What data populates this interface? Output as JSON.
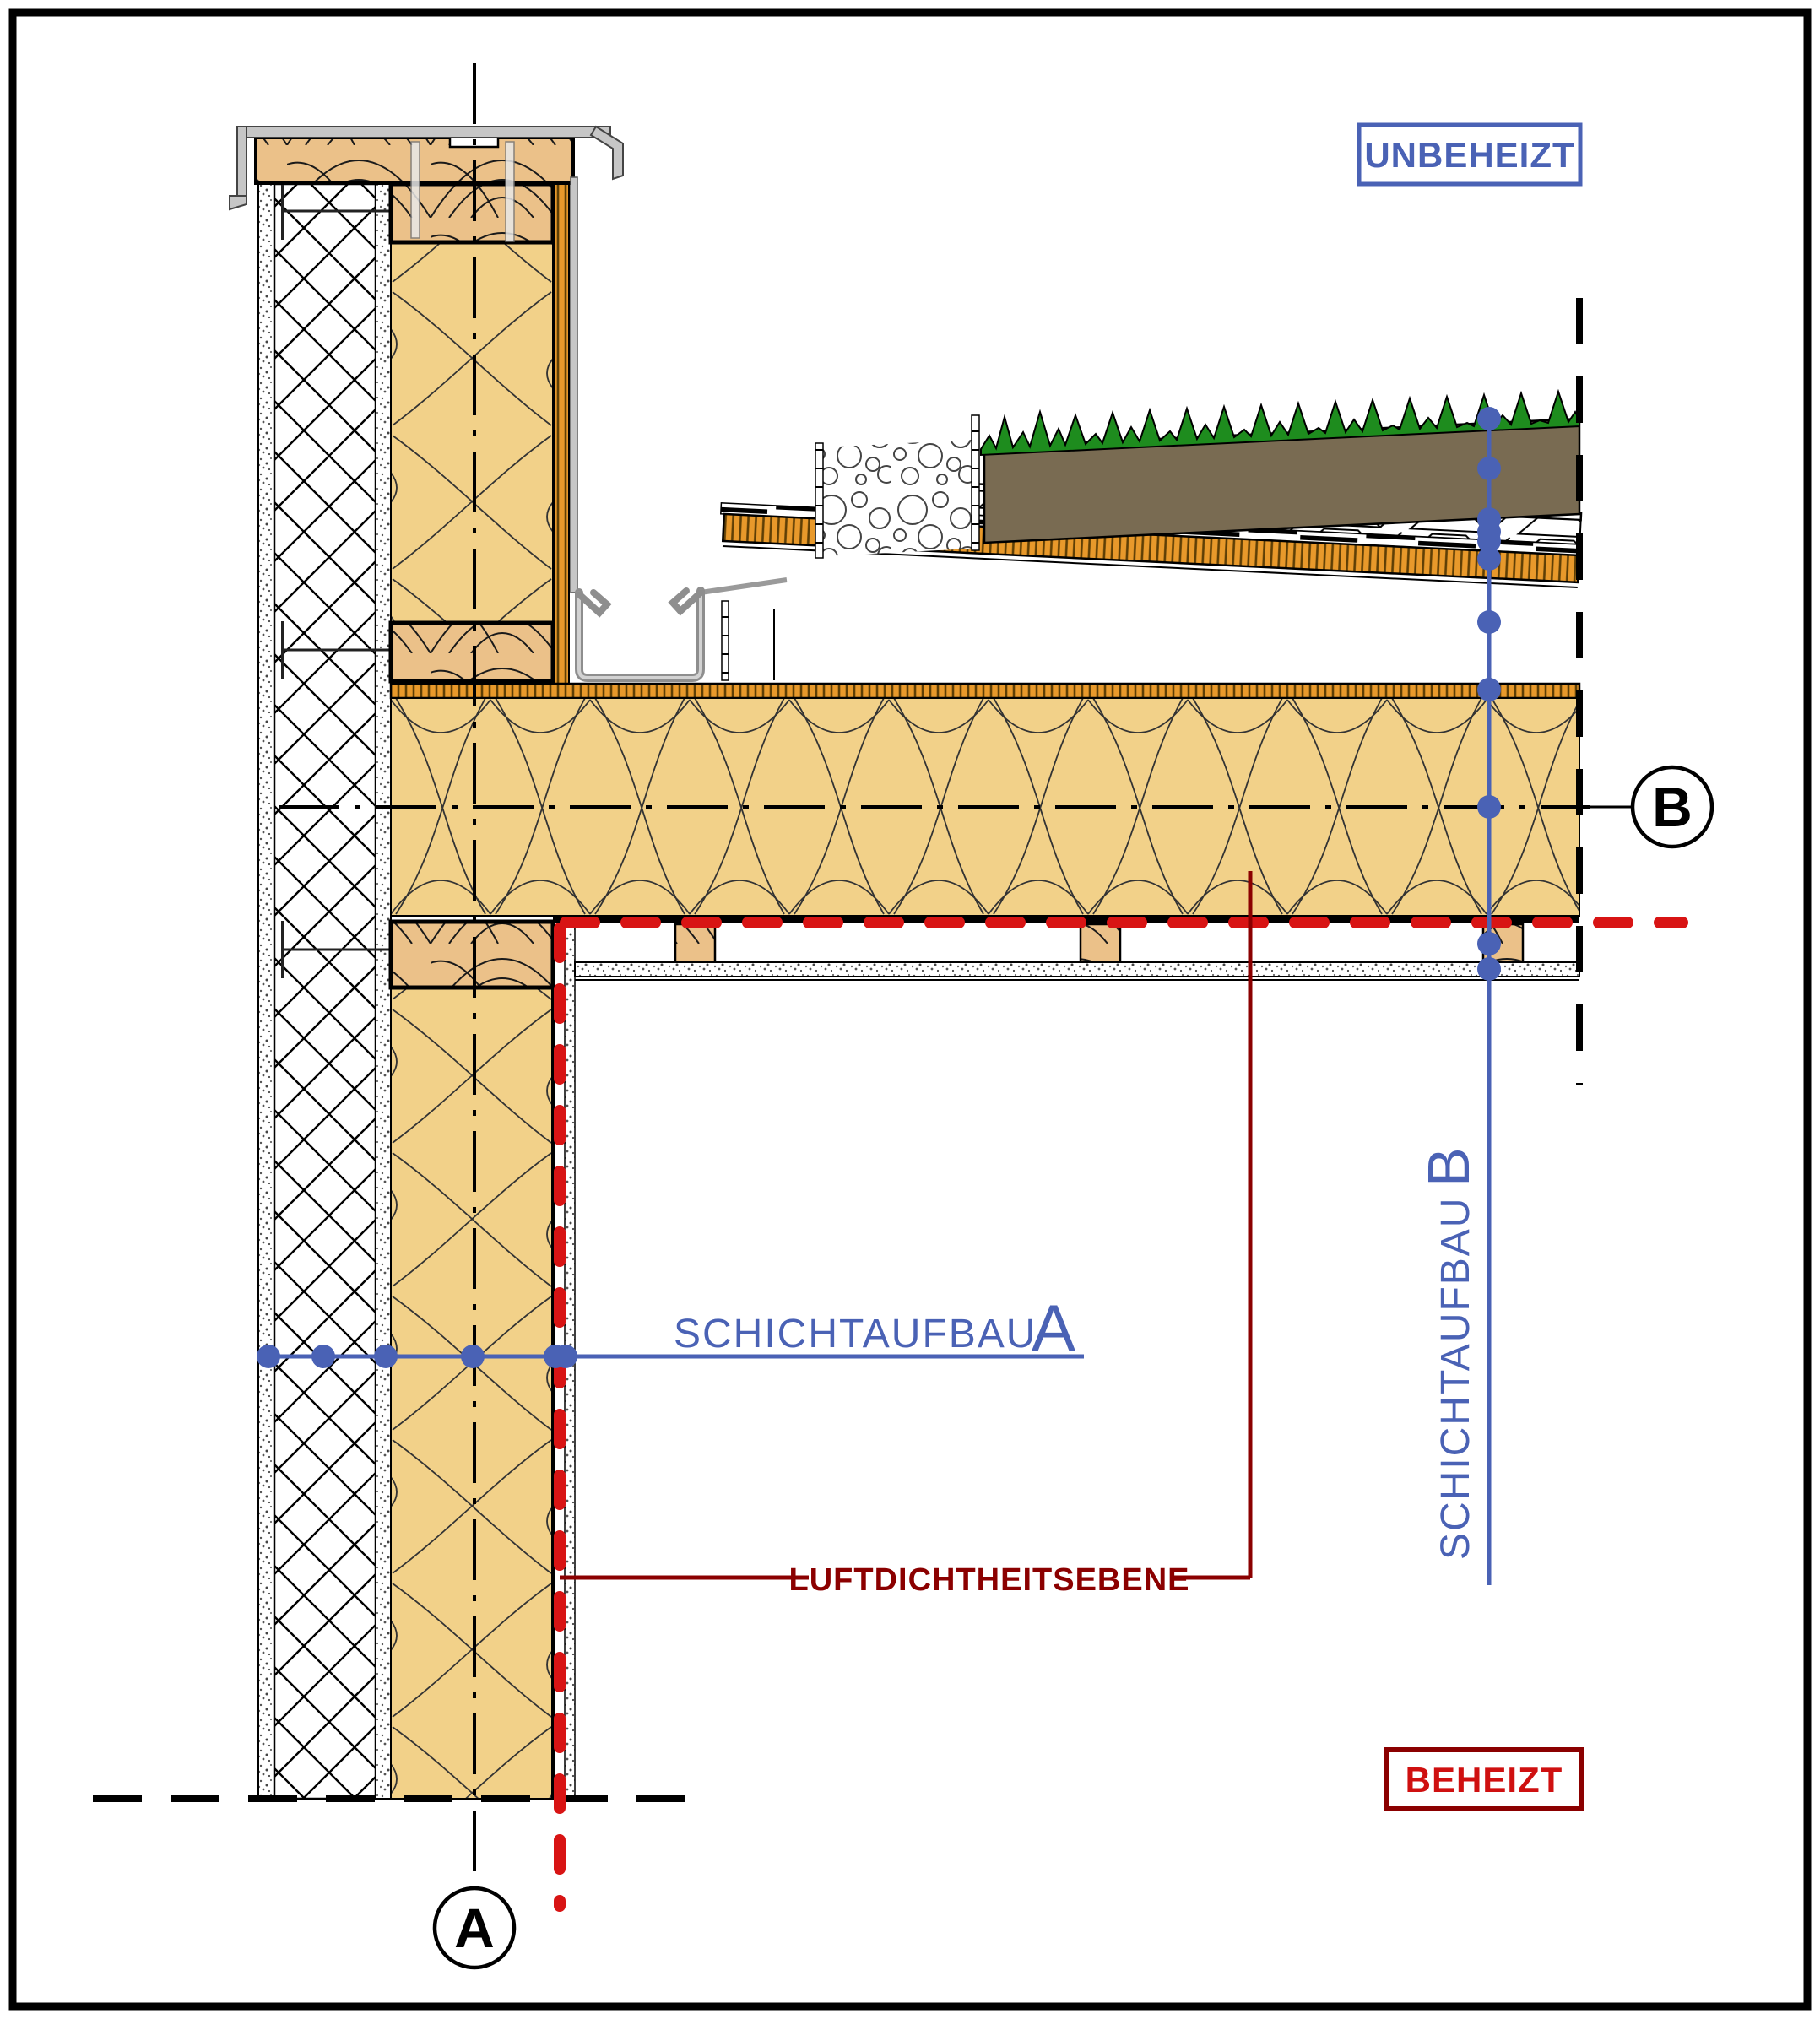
{
  "drawing": {
    "labels": {
      "unheated": "UNBEHEIZT",
      "heated": "BEHEIZT",
      "layer_a_text": "SCHICHTAUFBAU",
      "layer_a_letter": "A",
      "layer_b_text": "SCHICHTAUFBAU",
      "layer_b_letter": "B",
      "airtightness": "LUFTDICHTHEITSEBENE",
      "marker_a": "A",
      "marker_b": "B"
    },
    "colors": {
      "blue": "#4A62B5",
      "red_dash": "#D81414",
      "red_dark": "#8B0000",
      "red_text": "#CF1010",
      "insulation_yellow": "#F2D189",
      "wood_fill": "#EBC189",
      "board_orange": "#E8992B",
      "substrate_brown": "#796B52",
      "grass_green": "#1E8C1E",
      "metal_gray": "#C6C6C6",
      "line_black": "#000000"
    }
  }
}
